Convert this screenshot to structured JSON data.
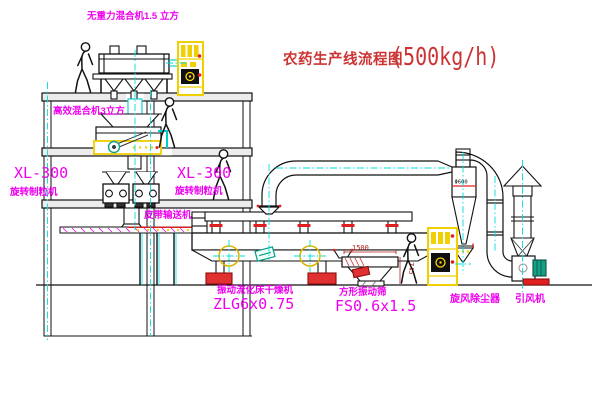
{
  "title": {
    "text": "农药生产线流程图",
    "capacity": "(500kg/h)"
  },
  "labels": {
    "gravity_mixer": "无重力混合机1.5 立方",
    "high_efficiency_mixer": "高效混合机3立方",
    "granulator_left_model": "XL-300",
    "granulator_left_name": "旋转制粒机",
    "granulator_mid_model": "XL-300",
    "granulator_mid_name": "旋转制粒机",
    "belt_conveyor": "皮带输送机",
    "dryer_name": "振动流化床干燥机",
    "dryer_model": "ZLG6x0.75",
    "screen_name": "方形振动筛",
    "screen_model": "FS0.6x1.5",
    "cyclone": "旋风除尘器",
    "fan": "引风机"
  },
  "dimensions": {
    "screen_length": "1500",
    "screen_height": "745",
    "cyclone_diameter": "Φ600"
  },
  "colors": {
    "label_magenta": "#EE00EE",
    "title_red": "#CC3333",
    "centerline_cyan": "#00DEDE",
    "cad_yellow": "#F0D000",
    "accent_red": "#E02020",
    "motor_teal": "#16A085"
  }
}
